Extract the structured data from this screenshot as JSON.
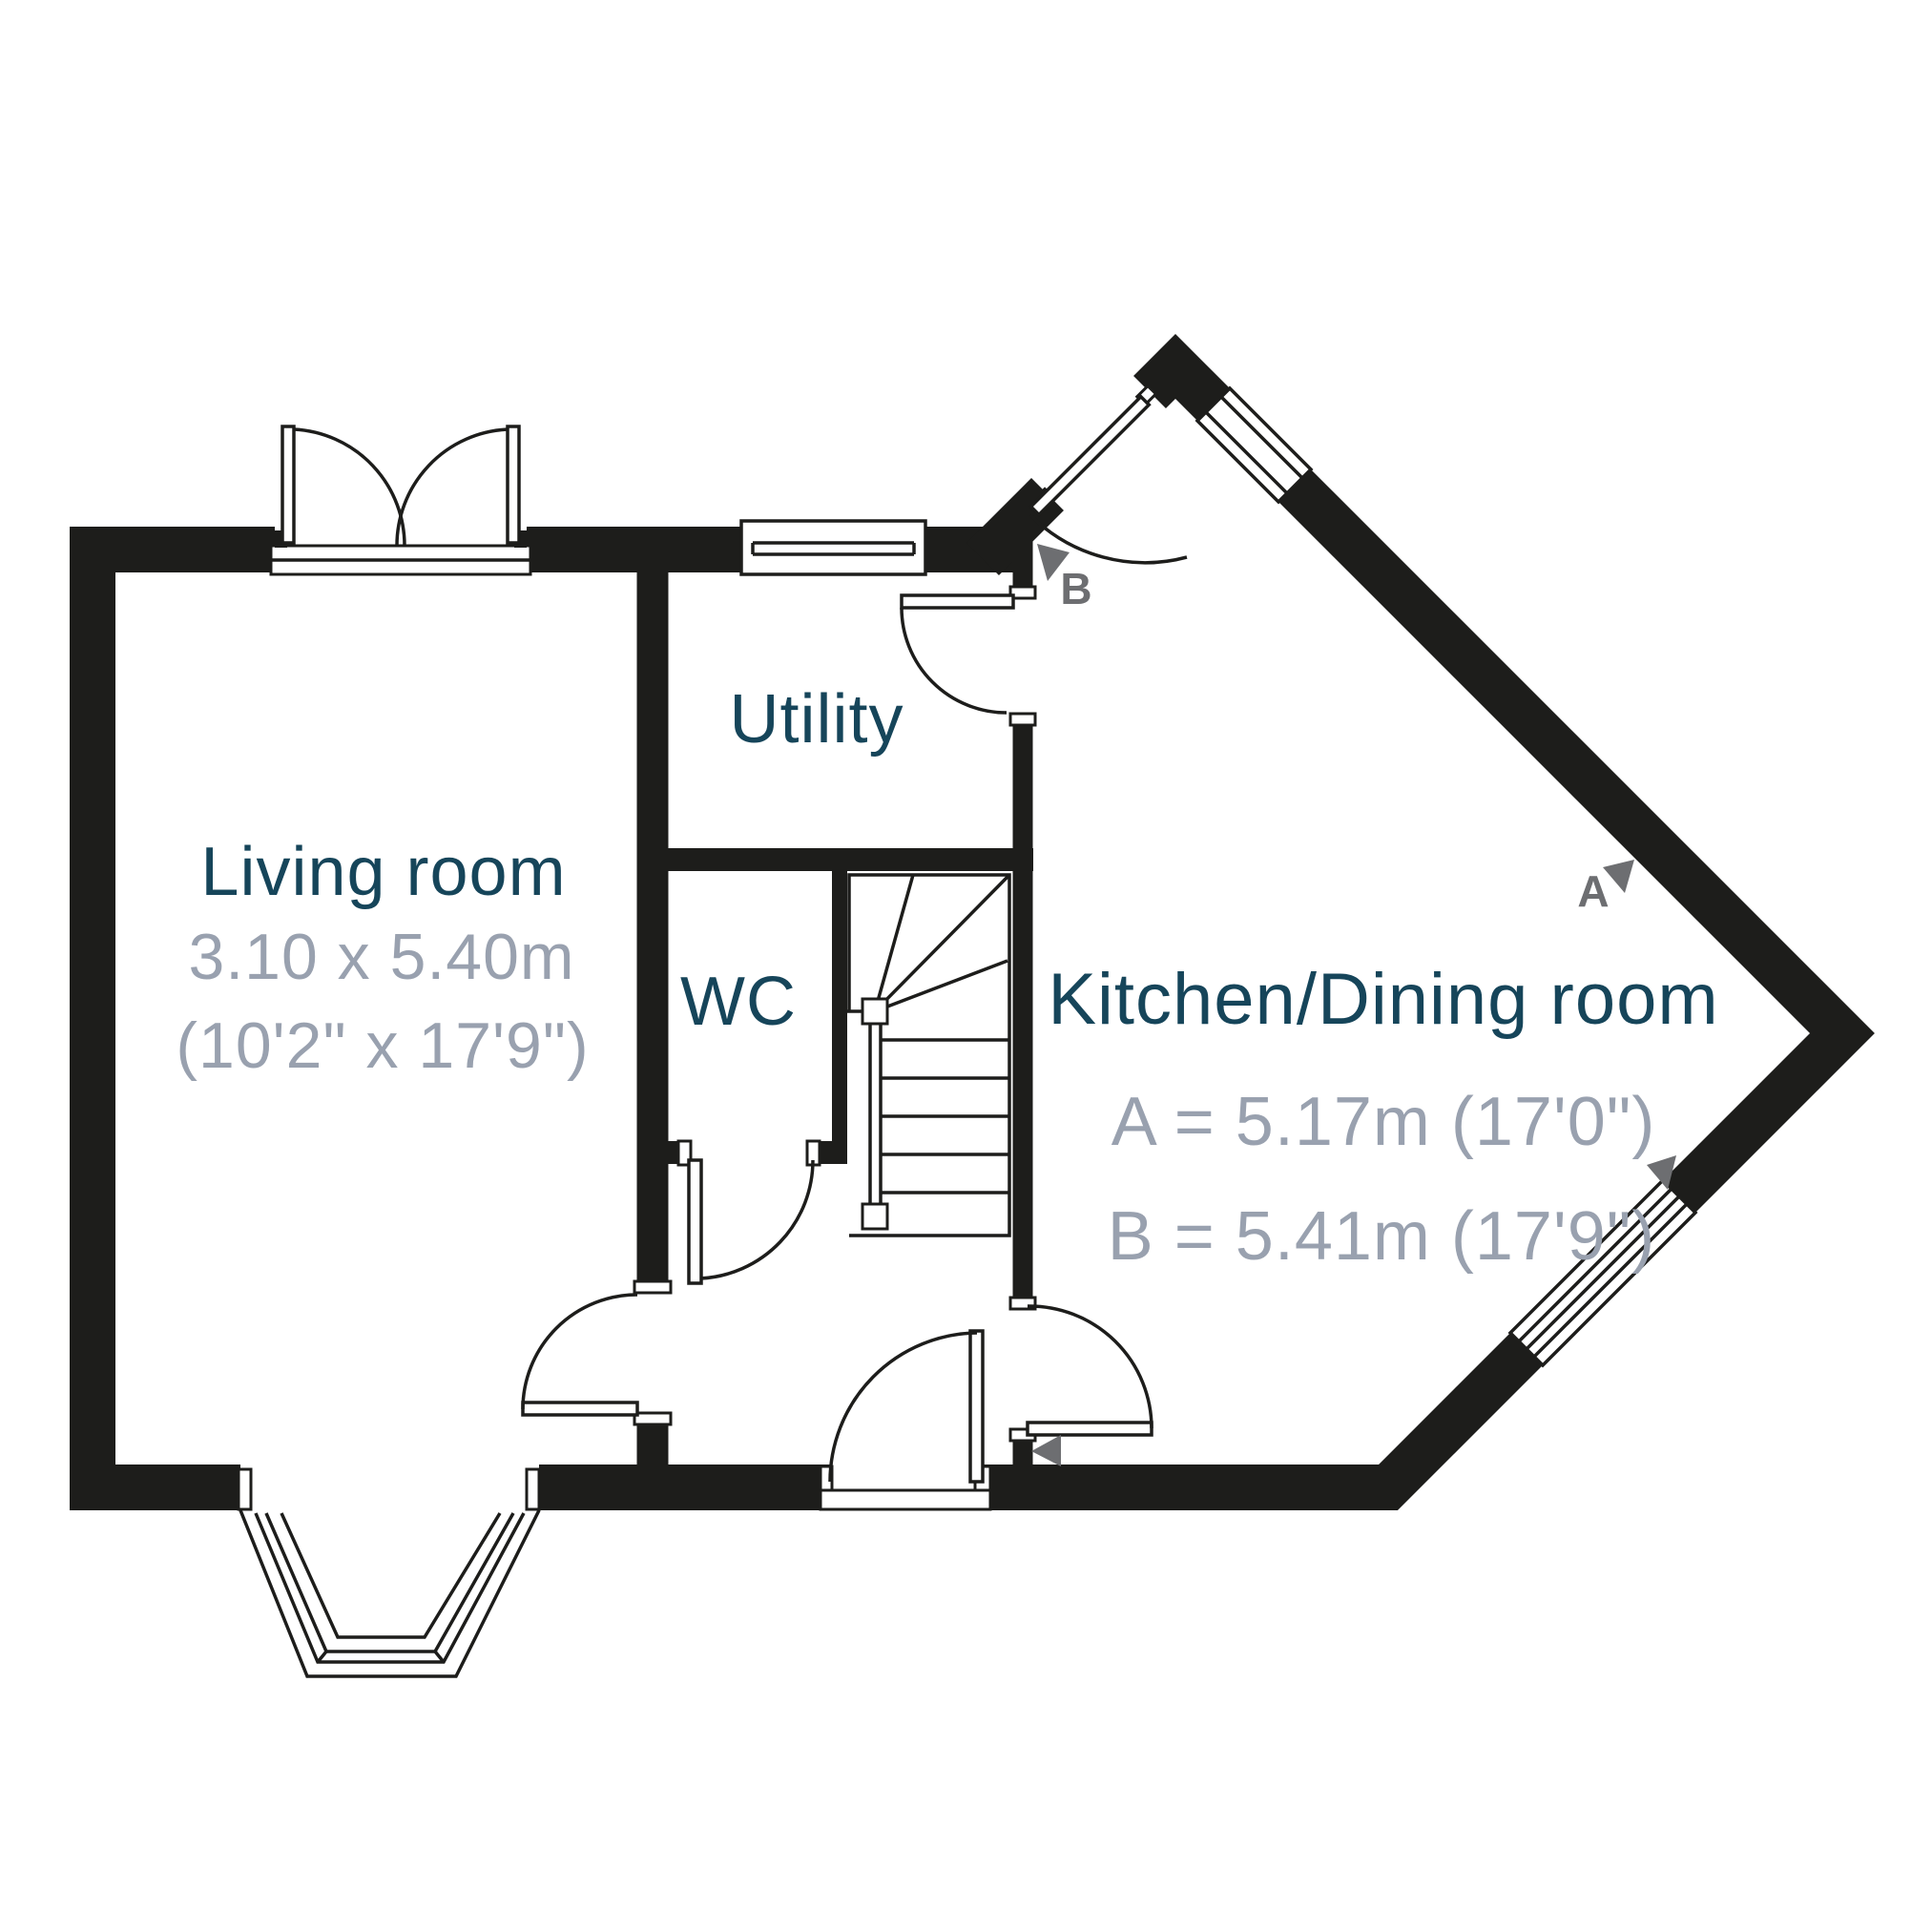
{
  "plan": {
    "title": "Ground floor plan",
    "rooms": {
      "living": {
        "name": "Living room",
        "dim_metric": "3.10 x 5.40m",
        "dim_imperial": "(10'2\" x 17'9\")"
      },
      "utility": {
        "name": "Utility"
      },
      "wc": {
        "name": "WC"
      },
      "kitchen": {
        "name": "Kitchen/Dining room",
        "dim_a": "A = 5.17m (17'0\")",
        "dim_b": "B = 5.41m (17'9\")"
      }
    },
    "markers": {
      "a": {
        "label": "A"
      },
      "b": {
        "label": "B"
      }
    },
    "colors": {
      "wall": "#1d1d1b",
      "room_label": "#16455a",
      "dimension_text": "#99a1af",
      "marker": "#6d6e71",
      "background": "#ffffff"
    }
  }
}
